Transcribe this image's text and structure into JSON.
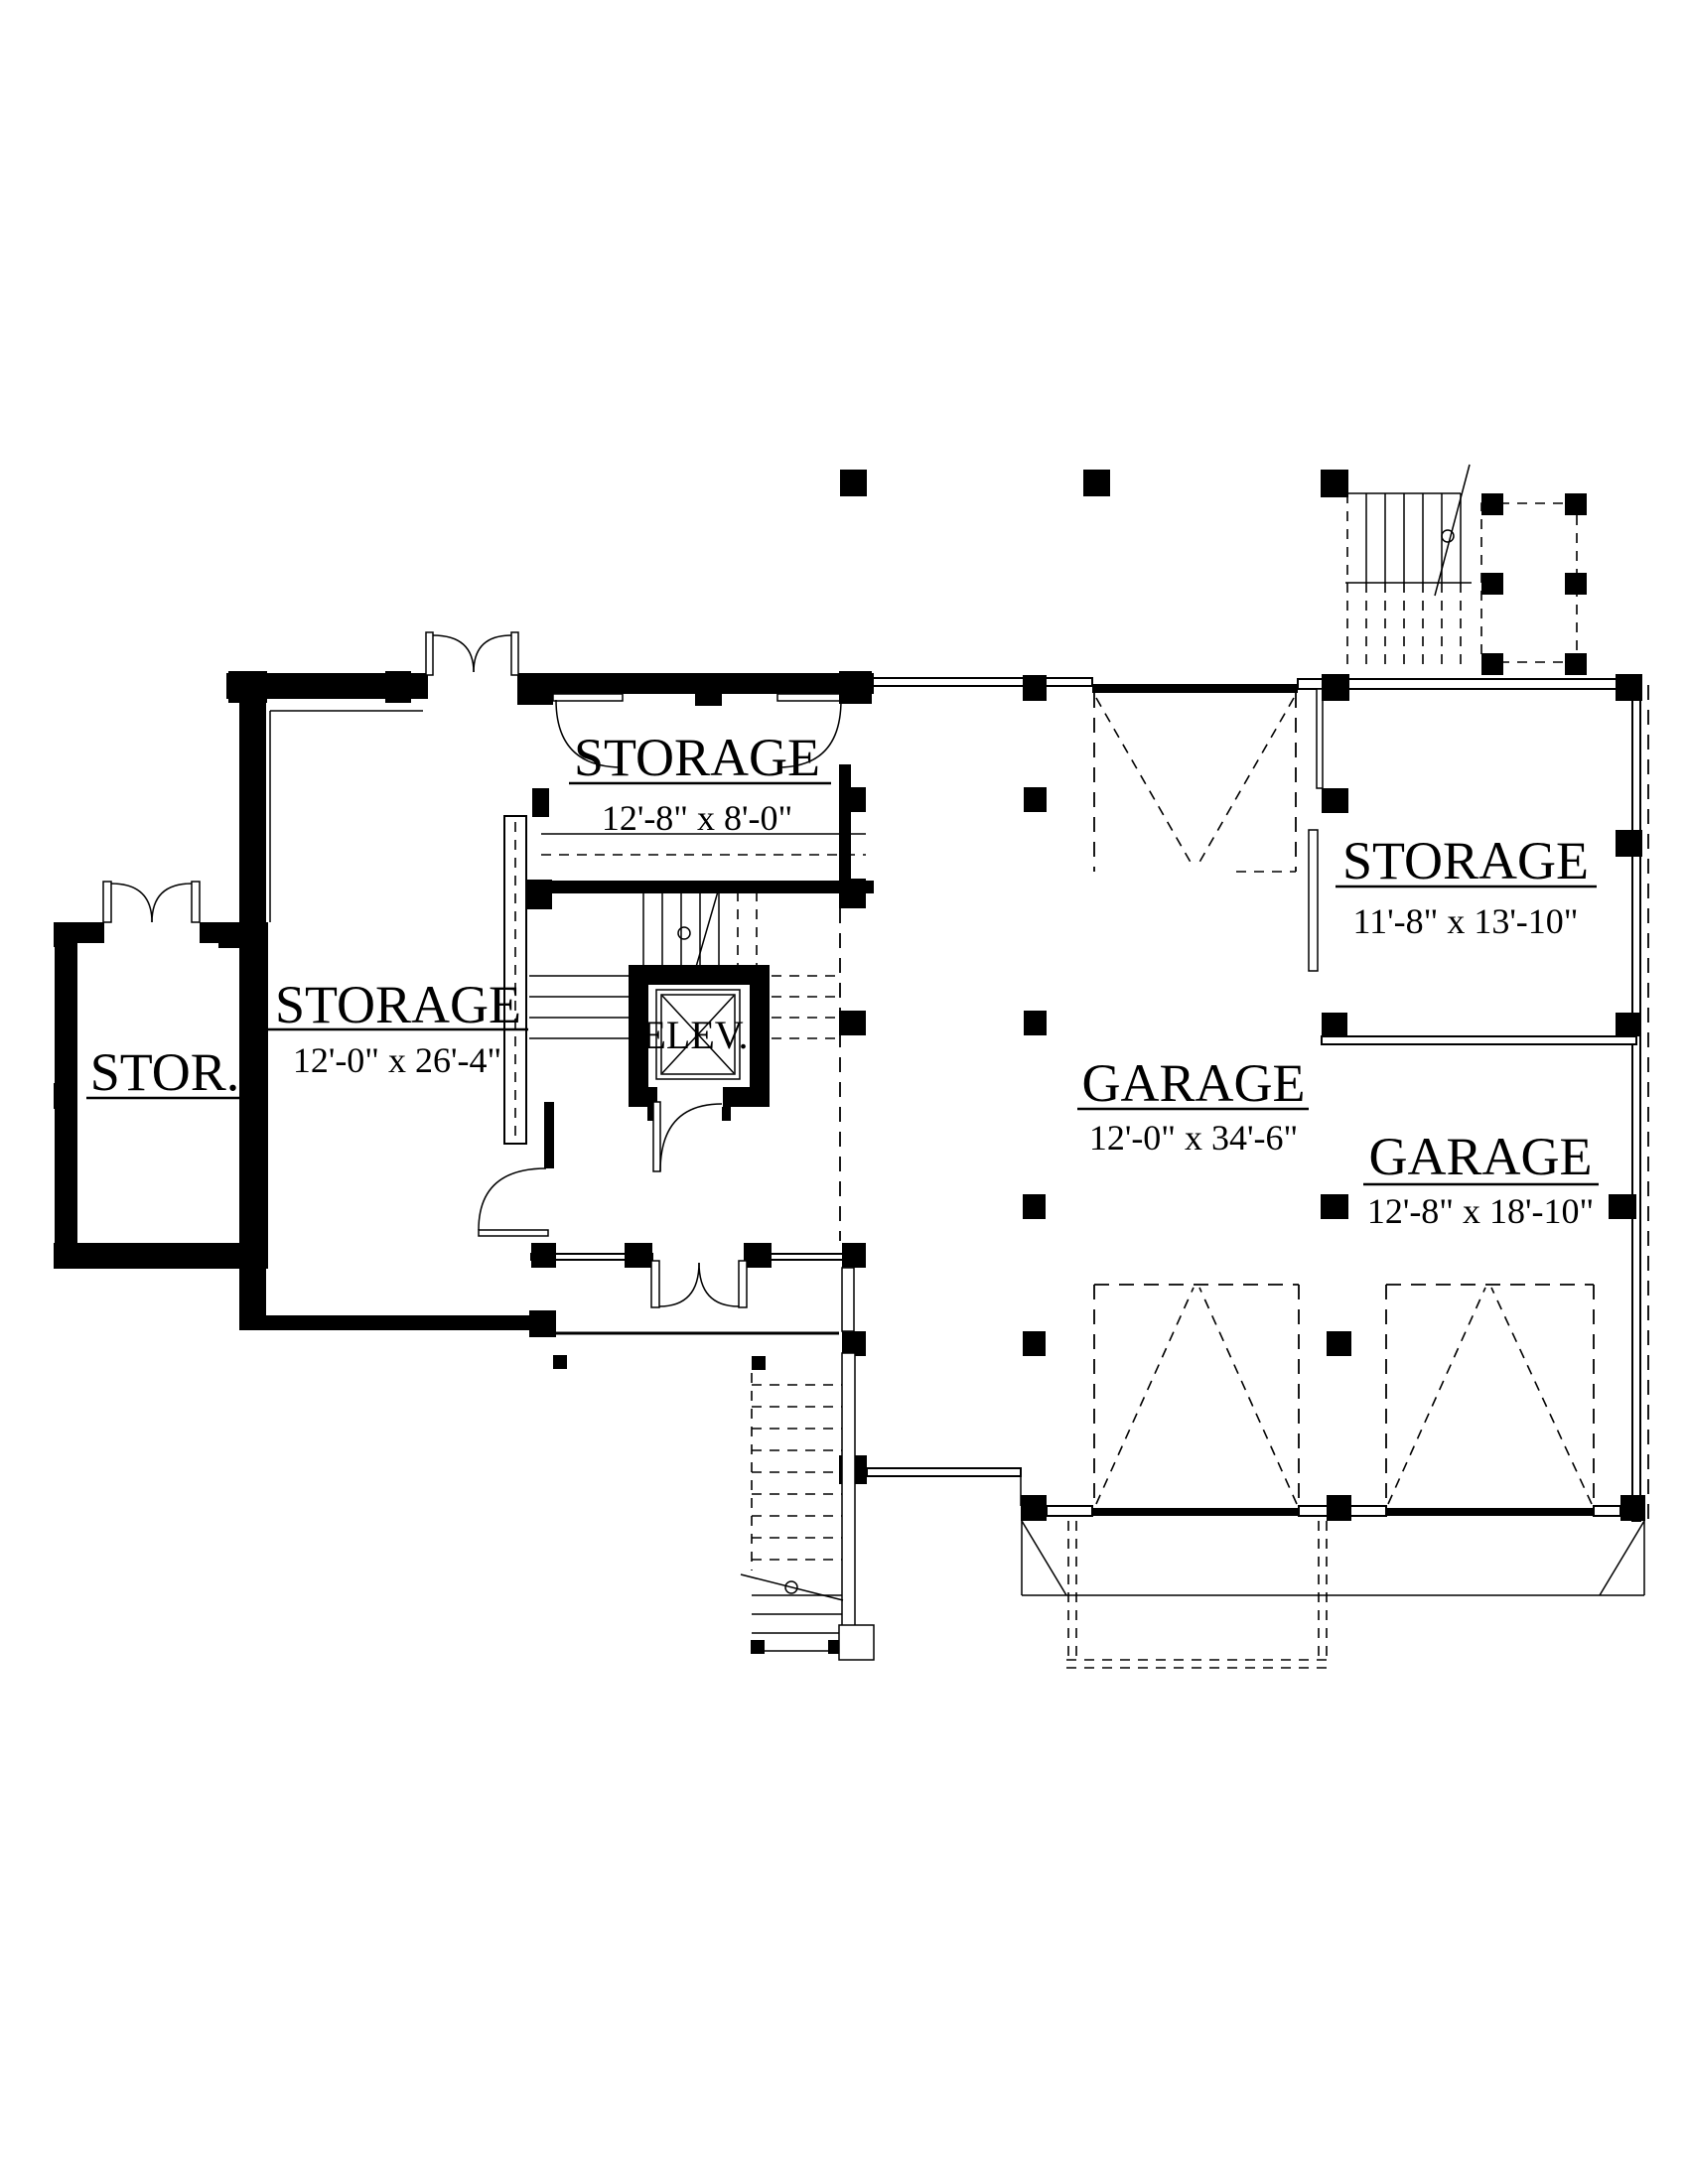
{
  "plan": {
    "type": "architectural-floor-plan",
    "colors": {
      "line": "#000000",
      "background": "#ffffff"
    },
    "rooms": [
      {
        "id": "storage-top",
        "name": "STORAGE",
        "dims": "12'-8\" x 8'-0\""
      },
      {
        "id": "storage-left",
        "name": "STORAGE",
        "dims": "12'-0\" x 26'-4\""
      },
      {
        "id": "stor",
        "name": "STOR.",
        "dims": ""
      },
      {
        "id": "elevator",
        "name": "ELEV.",
        "dims": ""
      },
      {
        "id": "storage-right",
        "name": "STORAGE",
        "dims": "11'-8\" x 13'-10\""
      },
      {
        "id": "garage-main",
        "name": "GARAGE",
        "dims": "12'-0\" x 34'-6\""
      },
      {
        "id": "garage-right",
        "name": "GARAGE",
        "dims": "12'-8\" x 18'-10\""
      }
    ]
  }
}
